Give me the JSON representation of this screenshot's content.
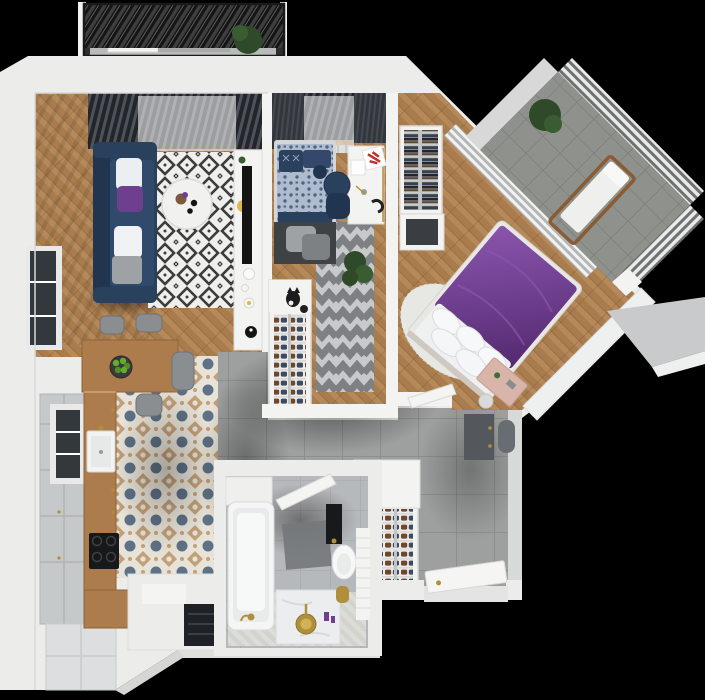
{
  "scene": {
    "title": "3D rendered top-down floor plan of a two-bedroom apartment with two balconies",
    "width_px": 705,
    "height_px": 700,
    "background": "#000000"
  },
  "palette": {
    "bg": "#000000",
    "shell": "#ececeb",
    "wallFace": "#d8d9d9",
    "white": "#f3f3f2",
    "wood": "#b5895a",
    "woodDark": "#a87c4c",
    "counter": "#ad7c4d",
    "cabinetGray": "#c6c9ca",
    "cabinetWhite": "#dcdedf",
    "hallTile": "#9da09f",
    "hallGrout": "#878a89",
    "kitchenBase": "#e8e3d8",
    "kitchenBlue": "#5e7186",
    "kitchenTan": "#c2a078",
    "bathTile": "#b6b9bb",
    "bathGrout": "#a5a8aa",
    "balconyTile": "#8f918d",
    "navy": "#2a415e",
    "navyDark": "#223550",
    "duvetBlue": "#aebcd0",
    "grayPillow": "#9ea2a5",
    "purple": "#6f3f8f",
    "purpleLight": "#8a55ad",
    "fur": "#e7e8e4",
    "pink": "#d9b4a9",
    "chevronA": "#7e8184",
    "chevronB": "#c7c9cb",
    "rugWhite": "#efefec",
    "rugBlack": "#3c3c3c",
    "stool": "#8b8e90",
    "gold": "#b08f3c",
    "plant": "#2e4a28",
    "plantLight": "#3a5c33",
    "apple": "#63ad2e",
    "tv": "#141414",
    "glass": "#33383d",
    "slab": "#c9cacb",
    "darkWardrobe": "#54585c",
    "pouf": "#686d71",
    "niche": "#151515",
    "mat": "#75787b",
    "yellow": "#dfb84a",
    "shoeBrown": "#6f482a",
    "shoeNavy": "#3e4a60"
  },
  "rooms": [
    {
      "id": "living-room",
      "label": "Living room",
      "floor": "wood-herringbone",
      "furniture": [
        "navy-sofa",
        "sofa-pillows-white-purple",
        "diamond-pattern-rug",
        "round-coffee-table",
        "tv-console",
        "tv",
        "yellow-stool",
        "decor-dishes",
        "cat-bowl",
        "window-blinds",
        "sheer-curtain",
        "side-windows"
      ]
    },
    {
      "id": "kitchen",
      "label": "Kitchen",
      "floor": "patterned-ceramic-tile",
      "furniture": [
        "breakfast-bar",
        "fruit-bowl-apples",
        "bar-stools-x4",
        "wood-counter",
        "sink",
        "cooktop",
        "tall-gray-cabinets",
        "white-base-cabinets",
        "appliance-block",
        "side-window"
      ]
    },
    {
      "id": "kids-room",
      "label": "Kids bedroom / study",
      "floor": "wood-herringbone",
      "furniture": [
        "single-bed-blue",
        "desk",
        "red-poster",
        "desk-chair-navy",
        "chevron-rug",
        "plant",
        "shoe-shelf-unit",
        "cat",
        "dark-curtains",
        "sheer-curtain",
        "radiator"
      ]
    },
    {
      "id": "bedroom",
      "label": "Master bedroom",
      "floor": "wood-herringbone",
      "furniture": [
        "double-bed-purple",
        "white-pillows",
        "fur-rug",
        "pink-vanity",
        "open-wardrobe-shelves",
        "dresser",
        "pleated-curtains",
        "door-leaf"
      ]
    },
    {
      "id": "hallway",
      "label": "Entrance hall",
      "floor": "large-gray-tile",
      "furniture": [
        "shoe-rack",
        "dark-wardrobe",
        "pouf",
        "entrance-door",
        "storage-niche",
        "white-closet"
      ]
    },
    {
      "id": "bathroom",
      "label": "Bathroom",
      "floor": "light-herringbone-tile",
      "furniture": [
        "bathtub",
        "gold-faucet",
        "vanity-gold-basin",
        "toilet",
        "black-cistern-panel",
        "bath-mat",
        "tiled-half-wall",
        "gold-bin",
        "door-leaf",
        "shelf"
      ]
    },
    {
      "id": "top-balcony",
      "label": "Balcony with louvered pergola",
      "floor": "concrete",
      "furniture": [
        "pergola-louvers",
        "bench-with-cushion",
        "plant"
      ]
    },
    {
      "id": "corner-balcony",
      "label": "Corner balcony (rotated 45°)",
      "floor": "gray-tile-grid",
      "furniture": [
        "louver-screen",
        "deck-lounger",
        "plant",
        "white-parapet"
      ]
    }
  ]
}
